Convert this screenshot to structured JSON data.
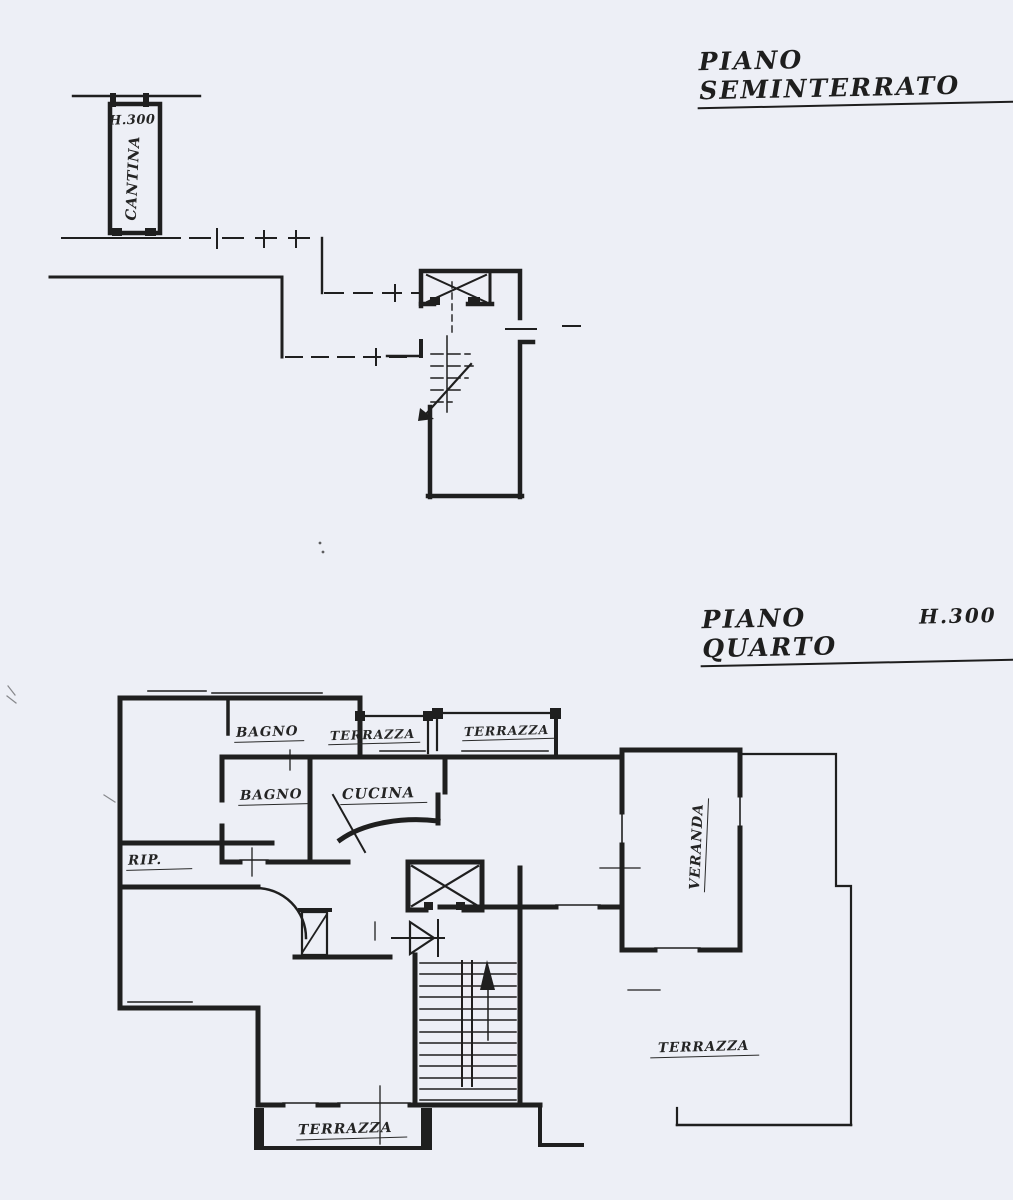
{
  "document": {
    "type": "scanned architectural floor plan",
    "paper_color": "#edeff6",
    "ink_color": "#1f1f1f"
  },
  "basement": {
    "title": "PIANO SEMINTERRATO",
    "labels": {
      "height": "H.300",
      "cantina": "CANTINA"
    }
  },
  "fourth_floor": {
    "title": "PIANO QUARTO",
    "title_height": "H.300",
    "labels": {
      "bagno_top": "BAGNO",
      "terrazza_top_left": "TERRAZZA",
      "terrazza_top_right": "TERRAZZA",
      "bagno": "BAGNO",
      "cucina": "CUCINA",
      "rip": "RIP.",
      "veranda": "VERANDA",
      "terrazza_east": "TERRAZZA",
      "terrazza_south": "TERRAZZA"
    }
  }
}
